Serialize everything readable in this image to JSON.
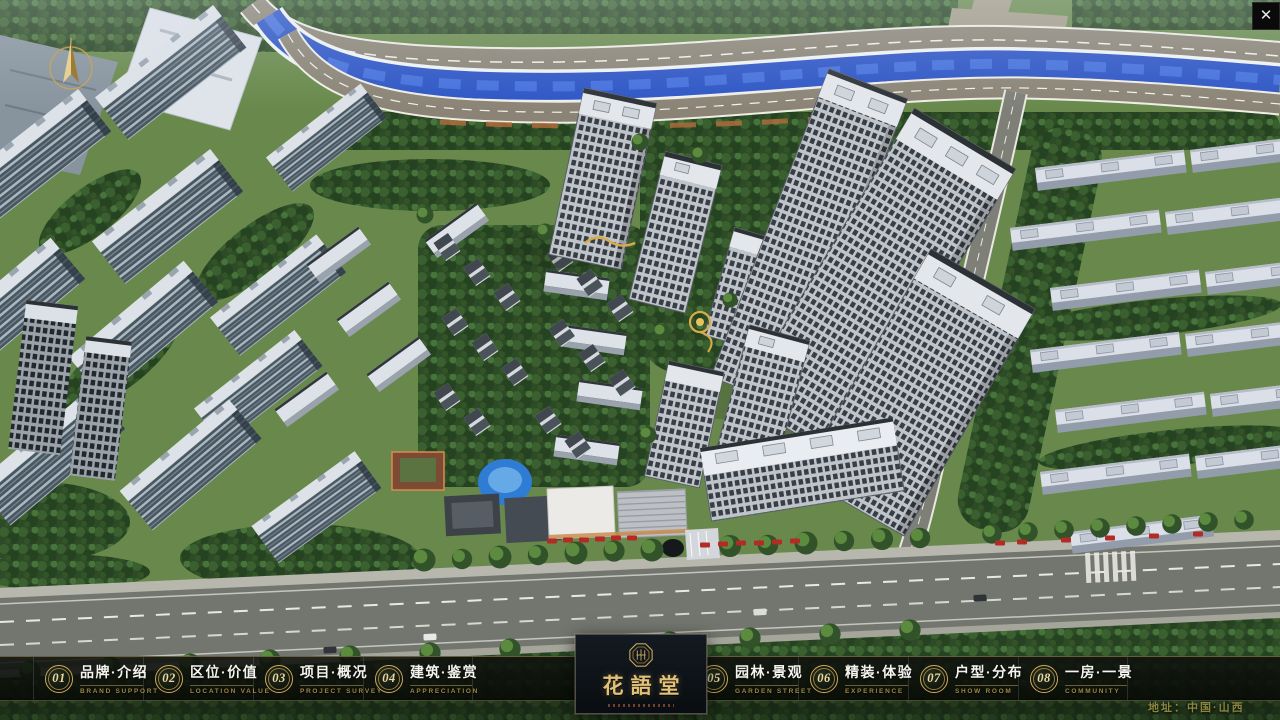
{
  "window": {
    "close_glyph": "✕"
  },
  "icons": {
    "close": "x-mark",
    "compass": "north-arrow"
  },
  "nav": {
    "items": [
      {
        "num": "01",
        "title": "品牌·介绍",
        "subtitle": "BRAND SUPPORT"
      },
      {
        "num": "02",
        "title": "区位·价值",
        "subtitle": "LOCATION VALUE"
      },
      {
        "num": "03",
        "title": "项目·概况",
        "subtitle": "PROJECT SURVEY"
      },
      {
        "num": "04",
        "title": "建筑·鉴赏",
        "subtitle": "APPRECIATION"
      },
      {
        "num": "05",
        "title": "园林·景观",
        "subtitle": "GARDEN STREET"
      },
      {
        "num": "06",
        "title": "精装·体验",
        "subtitle": "EXPERIENCE"
      },
      {
        "num": "07",
        "title": "户型·分布",
        "subtitle": "SHOW ROOM"
      },
      {
        "num": "08",
        "title": "一房·一景",
        "subtitle": "COMMUNITY"
      }
    ]
  },
  "logo": {
    "name": "花語堂"
  },
  "footer": {
    "address": "地址：中国·山西"
  },
  "colors": {
    "gold": "#cfa95e",
    "gold_dim": "#9d8647",
    "text": "#f4f3ee",
    "river": "#2d55c5",
    "address": "#8a8640",
    "nav_bg": "#0b0e0a"
  }
}
